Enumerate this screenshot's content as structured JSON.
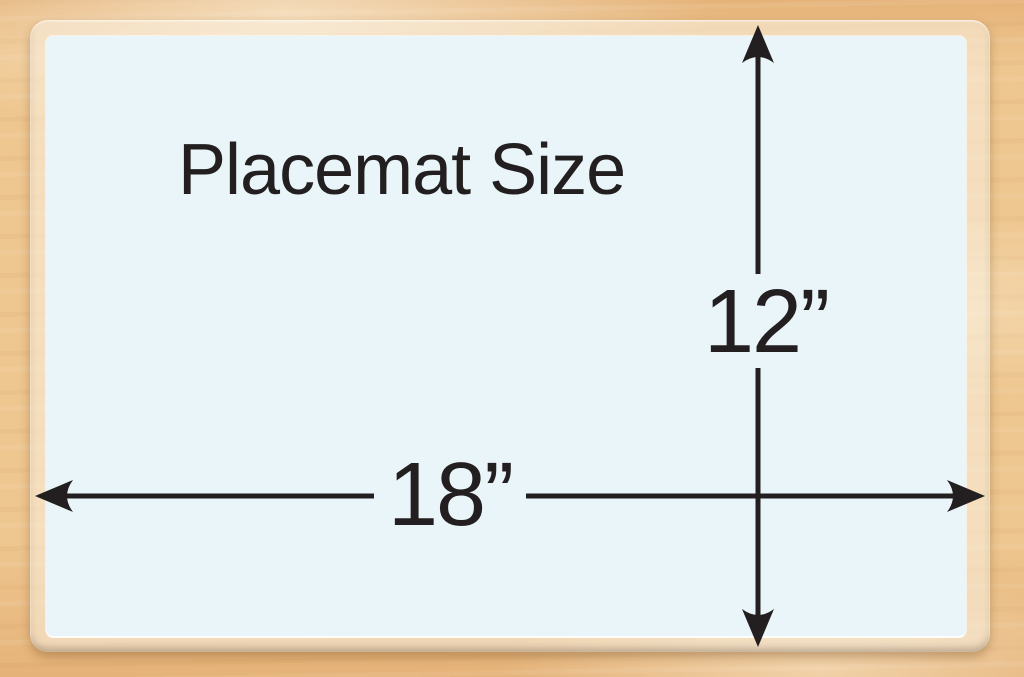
{
  "placemat": {
    "title": "Placemat Size",
    "height_label": "12”",
    "width_label": "18”"
  },
  "colors": {
    "wood": "#eec68f",
    "wood-dark": "#e5b379",
    "laminate": "rgba(250,242,228,0.55)",
    "mat": "#e9f5f9",
    "ink": "#231f20"
  }
}
